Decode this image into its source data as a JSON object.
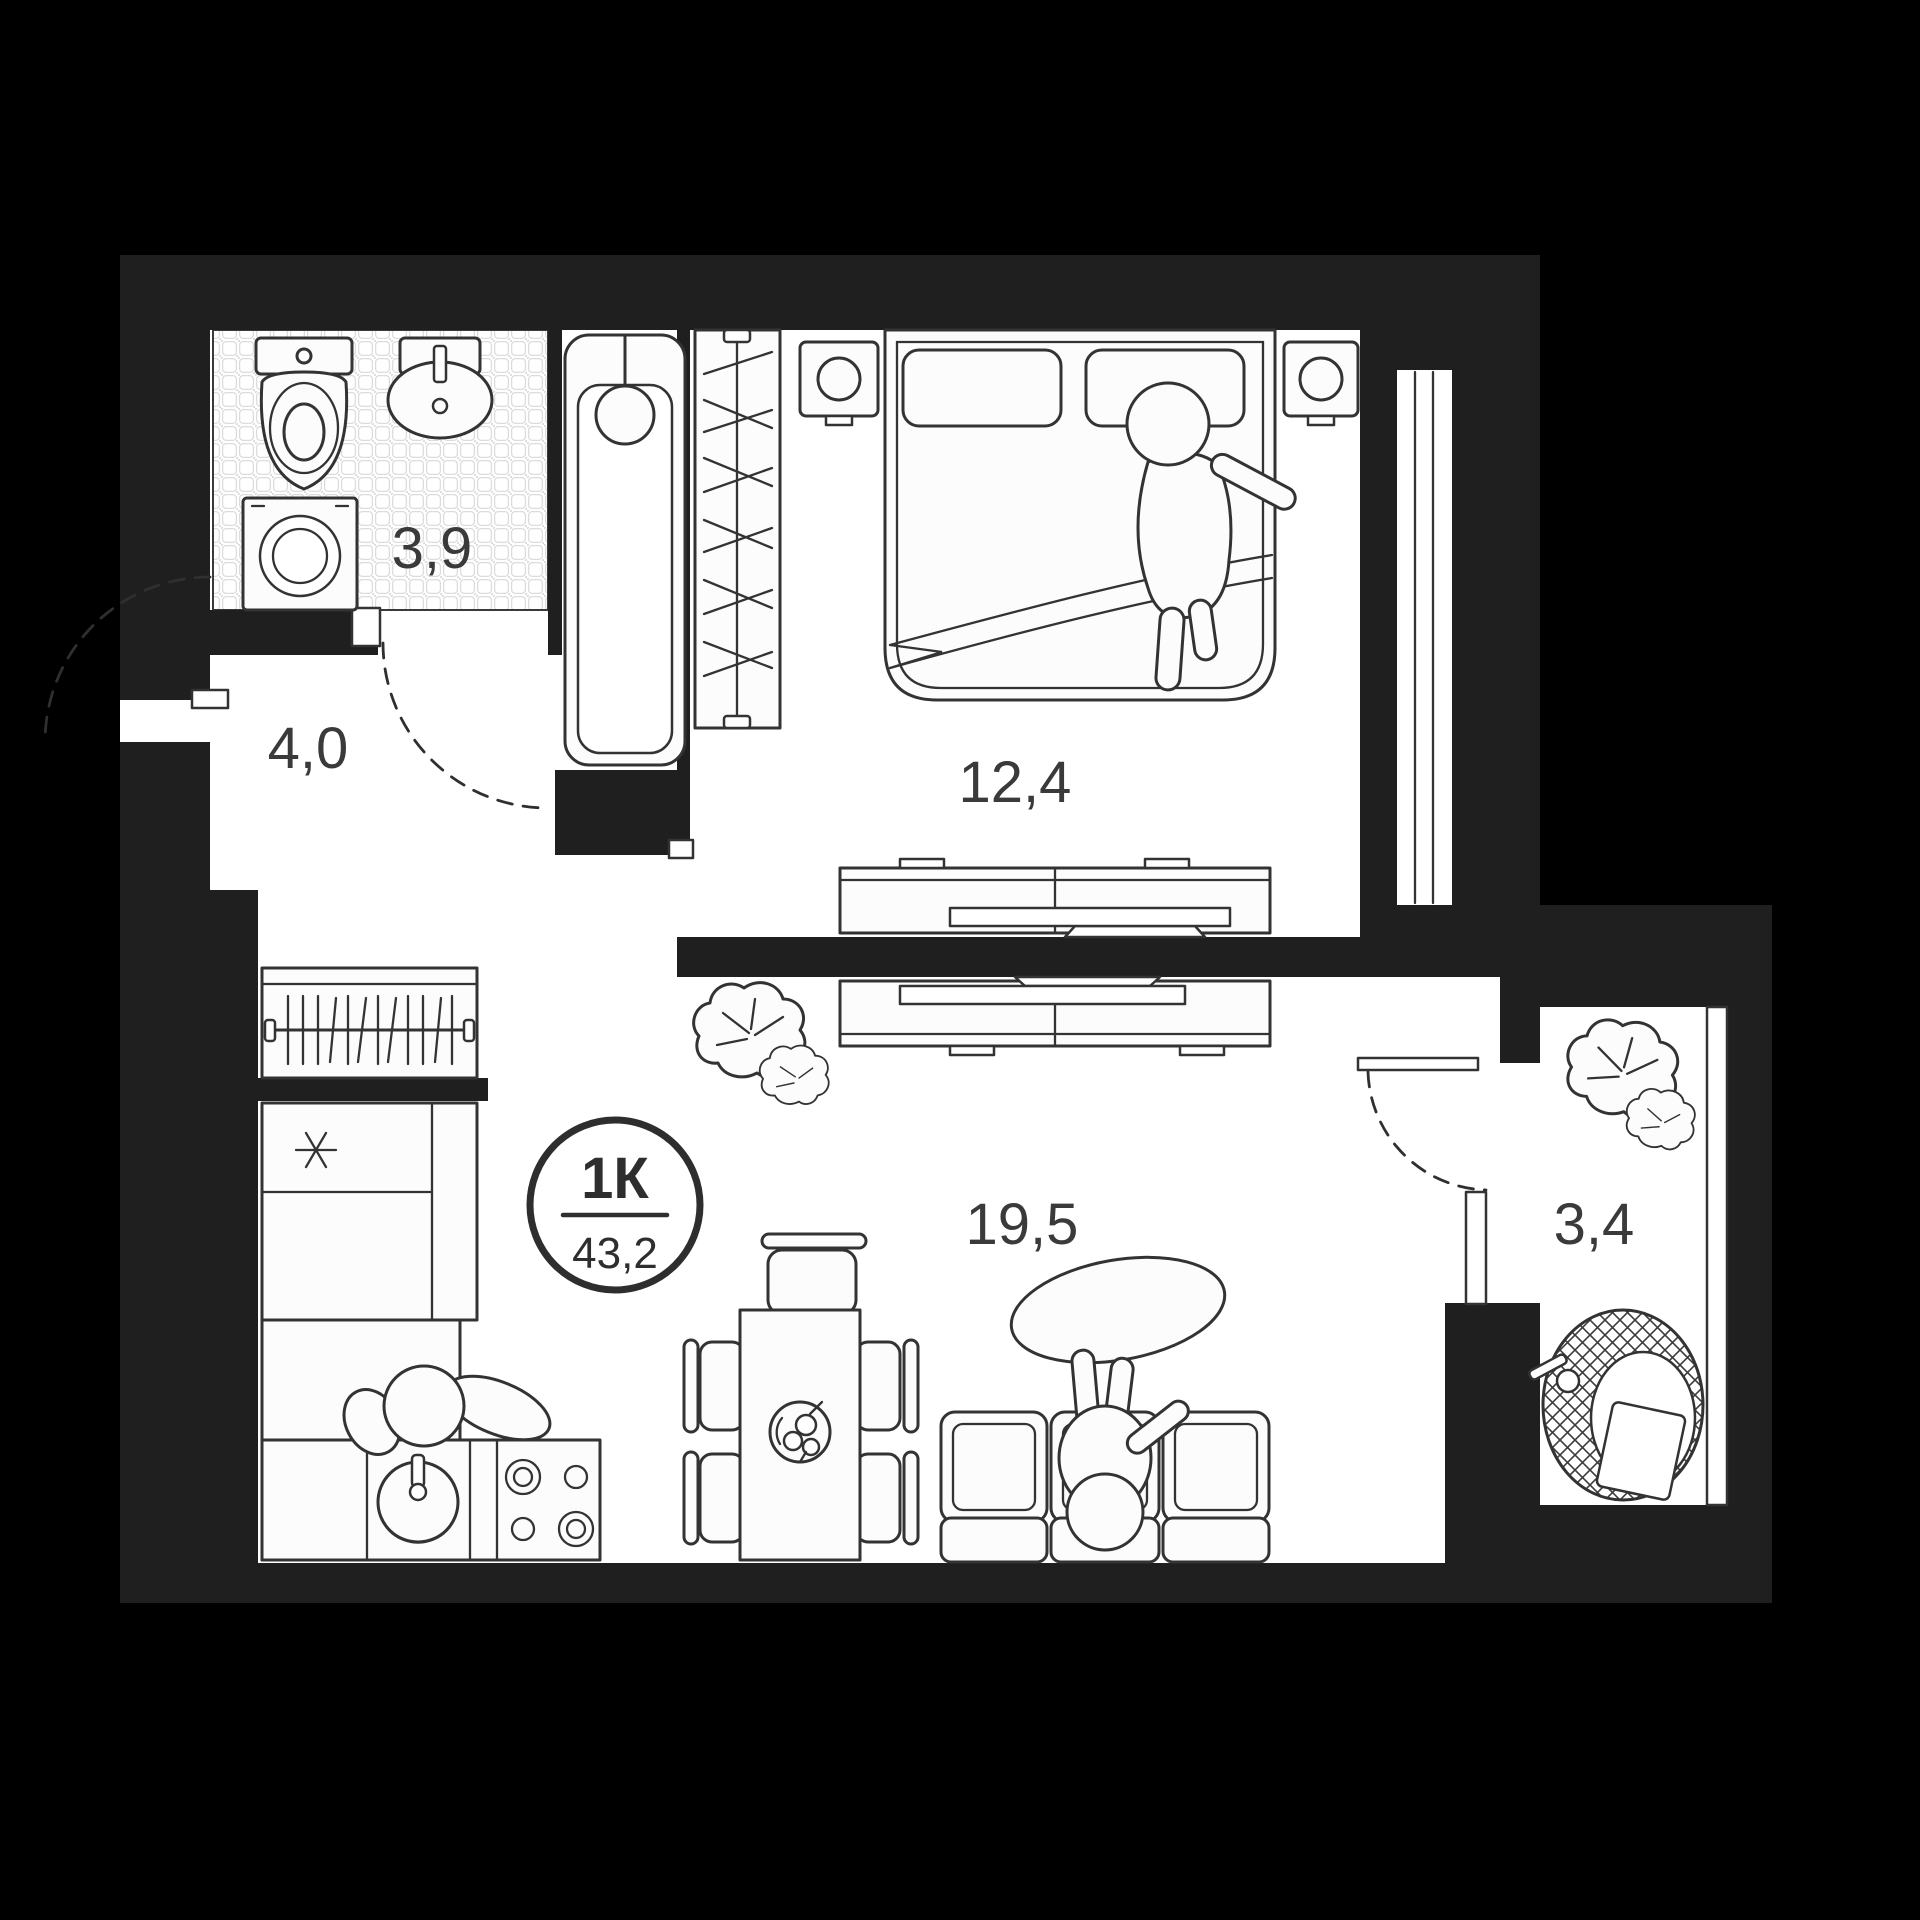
{
  "badge": {
    "type": "1К",
    "total_area": "43,2"
  },
  "rooms": {
    "bathroom": {
      "area": "3,9"
    },
    "bedroom": {
      "area": "12,4"
    },
    "hallway": {
      "area": "4,0"
    },
    "living_kitchen": {
      "area": "19,5"
    },
    "balcony": {
      "area": "3,4"
    }
  },
  "colors": {
    "background": "#000000",
    "wall": "#1f1f1f",
    "floor": "#ffffff",
    "line": "#333333",
    "text": "#3a3a3a"
  },
  "furniture_icons": [
    "toilet",
    "bathroom-sink",
    "bathtub",
    "washing-machine",
    "hallway-wardrobe",
    "bedroom-wardrobe",
    "double-bed",
    "pillows",
    "nightstand",
    "table-lamp",
    "person-on-bed",
    "tv-stand-bedroom",
    "tv-stand-living",
    "tv",
    "plant-living",
    "plant-balcony",
    "fridge",
    "kitchen-cabinet",
    "kitchen-sink",
    "stove",
    "person-at-kitchen",
    "dining-table",
    "dining-chair",
    "fruit-bowl",
    "sofa",
    "person-on-sofa",
    "coffee-table",
    "hanging-chair",
    "door-swing-arc",
    "window"
  ]
}
